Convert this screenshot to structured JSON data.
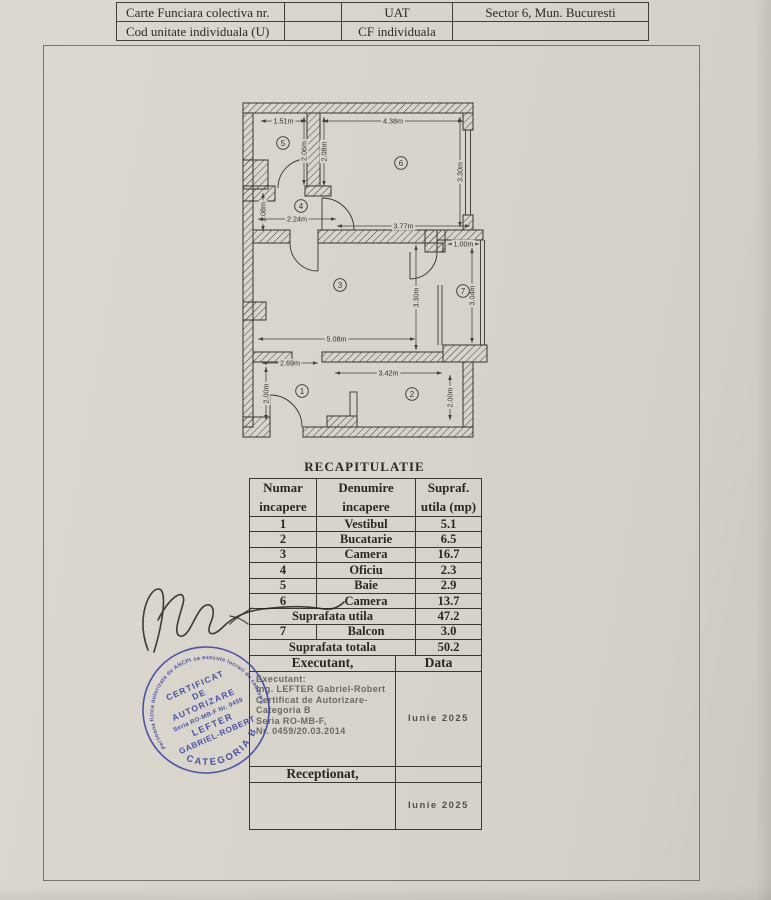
{
  "header_table": {
    "rows": [
      [
        "Carte Funciara colectiva nr.",
        "",
        "UAT",
        "Sector 6, Mun. Bucuresti"
      ],
      [
        "Cod unitate individuala (U)",
        "",
        "CF individuala",
        ""
      ]
    ]
  },
  "plan": {
    "rooms": [
      {
        "n": "5",
        "x": 40,
        "y": 40
      },
      {
        "n": "6",
        "x": 158,
        "y": 60
      },
      {
        "n": "4",
        "x": 58,
        "y": 103
      },
      {
        "n": "3",
        "x": 97,
        "y": 182
      },
      {
        "n": "7",
        "x": 220,
        "y": 188
      },
      {
        "n": "1",
        "x": 59,
        "y": 288
      },
      {
        "n": "2",
        "x": 169,
        "y": 291
      }
    ],
    "dims": [
      {
        "label": "1.51m",
        "x1": 18,
        "y1": 18,
        "x2": 63,
        "y2": 18
      },
      {
        "label": "4.38m",
        "x1": 80,
        "y1": 18,
        "x2": 220,
        "y2": 18
      },
      {
        "label": "2.06m",
        "x1": 61,
        "y1": 14,
        "x2": 61,
        "y2": 82
      },
      {
        "label": "2.08m",
        "x1": 81,
        "y1": 14,
        "x2": 81,
        "y2": 83
      },
      {
        "label": "3.30m",
        "x1": 217,
        "y1": 14,
        "x2": 217,
        "y2": 124
      },
      {
        "label": "1.08m",
        "x1": 20,
        "y1": 90,
        "x2": 20,
        "y2": 128
      },
      {
        "label": "2.24m",
        "x1": 15,
        "y1": 116,
        "x2": 93,
        "y2": 116
      },
      {
        "label": "3.77m",
        "x1": 94,
        "y1": 123,
        "x2": 227,
        "y2": 123
      },
      {
        "label": "1.00m",
        "x1": 205,
        "y1": 141,
        "x2": 236,
        "y2": 141
      },
      {
        "label": "3.30m",
        "x1": 173,
        "y1": 142,
        "x2": 173,
        "y2": 247
      },
      {
        "label": "3.04m",
        "x1": 229,
        "y1": 145,
        "x2": 229,
        "y2": 240
      },
      {
        "label": "5.08m",
        "x1": 15,
        "y1": 236,
        "x2": 172,
        "y2": 236
      },
      {
        "label": "2.69m",
        "x1": 19,
        "y1": 260,
        "x2": 75,
        "y2": 260
      },
      {
        "label": "3.42m",
        "x1": 92,
        "y1": 270,
        "x2": 199,
        "y2": 270
      },
      {
        "label": "2.00m",
        "x1": 23,
        "y1": 264,
        "x2": 23,
        "y2": 317
      },
      {
        "label": "2.00m",
        "x1": 207,
        "y1": 272,
        "x2": 207,
        "y2": 317
      }
    ]
  },
  "recap": {
    "title": "RECAPITULATIE",
    "col_headers": [
      [
        "Numar",
        "incapere"
      ],
      [
        "Denumire",
        "incapere"
      ],
      [
        "Supraf.",
        "utila (mp)"
      ]
    ],
    "rows": [
      [
        "1",
        "Vestibul",
        "5.1"
      ],
      [
        "2",
        "Bucatarie",
        "6.5"
      ],
      [
        "3",
        "Camera",
        "16.7"
      ],
      [
        "4",
        "Oficiu",
        "2.3"
      ],
      [
        "5",
        "Baie",
        "2.9"
      ],
      [
        "6",
        "Camera",
        "13.7"
      ],
      {
        "span": "Suprafata utila",
        "val": "47.2"
      },
      [
        "7",
        "Balcon",
        "3.0"
      ],
      {
        "span": "Suprafata totala",
        "val": "50.2"
      }
    ],
    "executant_header": "Executant,",
    "data_header": "Data",
    "executant_lines": [
      "Executant:",
      "Ing. LEFTER Gabriel-Robert",
      "Certificat de Autorizare-",
      "Categoria B",
      "Seria RO-MB-F,",
      "Nr. 0459/20.03.2014"
    ],
    "date1": "Iunie 2025",
    "receptionat": "Receptionat,",
    "date2": "Iunie 2025"
  },
  "stamp": {
    "arc_top": "Persoana fizica autorizata de ANCPI sa execute lucrari de cadastru",
    "line1": "CERTIFICAT",
    "line2": "DE",
    "line3": "AUTORIZARE",
    "line4": "Seria RO-MB-F Nr. 0459",
    "line5": "LEFTER",
    "line6": "GABRIEL-ROBERT",
    "arc_bottom": "CATEGORIA B",
    "color": "#3a46a2"
  }
}
